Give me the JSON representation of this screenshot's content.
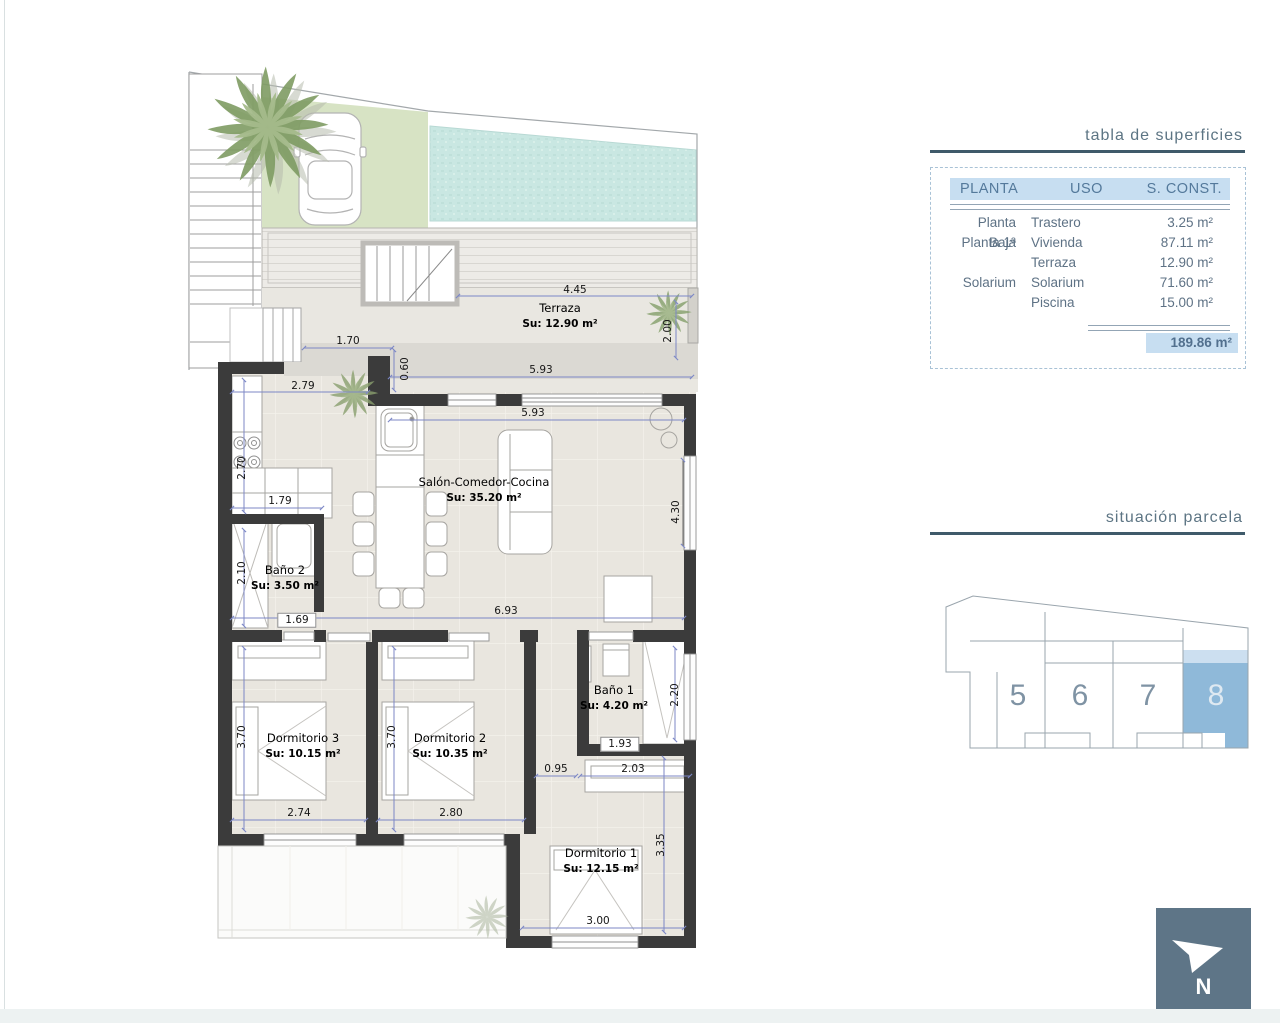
{
  "titles": {
    "table_title": "tabla de superficies",
    "parcela_title": "situación parcela"
  },
  "surface_table": {
    "headers": [
      "PLANTA",
      "USO",
      "S. CONST."
    ],
    "rows": [
      [
        "Planta Baja",
        "Trastero",
        "3.25 m²"
      ],
      [
        "Planta 1ª",
        "Vivienda",
        "87.11 m²"
      ],
      [
        "",
        "Terraza",
        "12.90 m²"
      ],
      [
        "Solarium",
        "Solarium",
        "71.60 m²"
      ],
      [
        "",
        "Piscina",
        "15.00 m²"
      ]
    ],
    "total": "189.86 m²"
  },
  "parcela": {
    "plots": [
      "5",
      "6",
      "7",
      "8"
    ],
    "highlighted_plot": "8",
    "highlight_color": "#8fb9d9"
  },
  "north": {
    "label": "N"
  },
  "rooms": [
    {
      "name": "Terraza",
      "area": "Su: 12.90 m²"
    },
    {
      "name": "Salón-Comedor-Cocina",
      "area": "Su: 35.20 m²"
    },
    {
      "name": "Baño 2",
      "area": "Su: 3.50 m²"
    },
    {
      "name": "Dormitorio 3",
      "area": "Su: 10.15 m²"
    },
    {
      "name": "Dormitorio 2",
      "area": "Su: 10.35 m²"
    },
    {
      "name": "Baño 1",
      "area": "Su: 4.20 m²"
    },
    {
      "name": "Dormitorio 1",
      "area": "Su: 12.15 m²"
    }
  ],
  "dims": [
    "4.45",
    "2.00",
    "1.70",
    "0.60",
    "5.93",
    "5.93",
    "2.79",
    "2.70",
    "1.79",
    "2.10",
    "1.69",
    "6.93",
    "4.30",
    "3.70",
    "3.70",
    "2.74",
    "2.80",
    "0.95",
    "2.03",
    "1.93",
    "2.20",
    "3.35",
    "3.00"
  ],
  "colors": {
    "wall": "#3b3b3b",
    "pool": "#c9e7e2",
    "garden": "#d7e3c4",
    "floor": "#e9e6df",
    "dim_line": "#7c87c6",
    "header_bg": "#c7def1",
    "north_bg": "#5e7587"
  }
}
